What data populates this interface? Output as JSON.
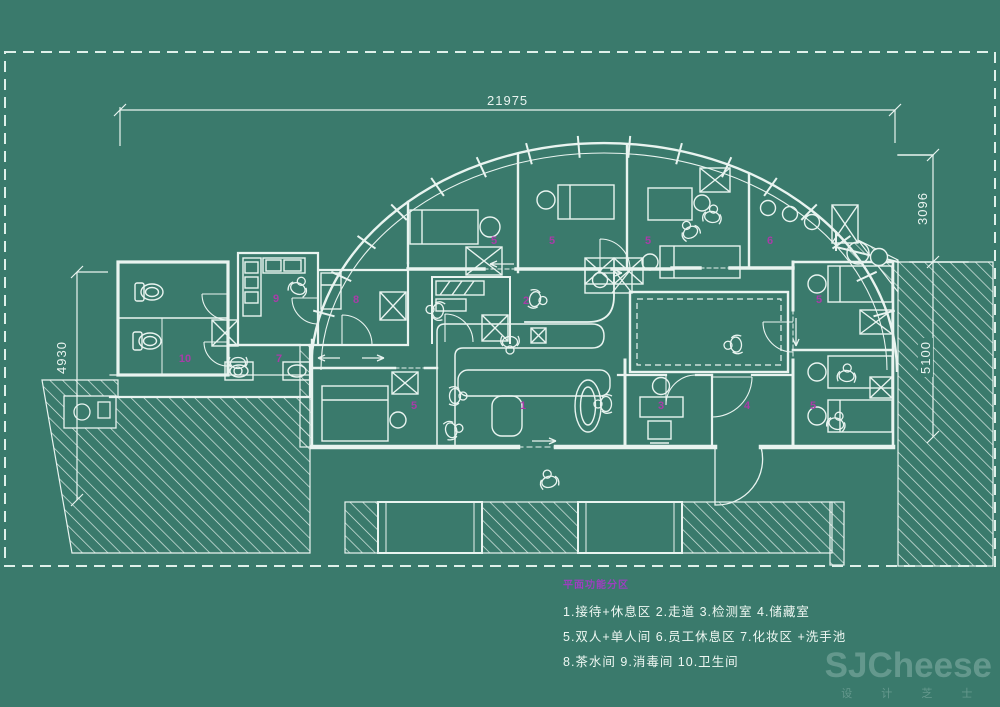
{
  "canvas": {
    "background_color": "#3a7a6c",
    "line_color": "#e9f4f0",
    "accent_magenta": "#a83ca8",
    "legend_title_color": "#9c3fbf"
  },
  "dimensions": {
    "top_width": "21975",
    "right_upper": "3096",
    "right_lower": "5100",
    "left_height": "4930"
  },
  "legend": {
    "title": "平面功能分区",
    "lines": [
      "1.接待+休息区   2.走道   3.检测室  4.储藏室",
      "5.双人+单人间  6.员工休息区  7.化妆区 +洗手池",
      "8.茶水间  9.消毒间   10.卫生间"
    ]
  },
  "rooms": [
    {
      "num": "1",
      "name": "接待+休息区",
      "x": 523,
      "y": 406
    },
    {
      "num": "2",
      "name": "走道",
      "x": 526,
      "y": 301
    },
    {
      "num": "3",
      "name": "检测室",
      "x": 661,
      "y": 406
    },
    {
      "num": "4",
      "name": "储藏室",
      "x": 747,
      "y": 406
    },
    {
      "num": "5",
      "name": "双人+单人间",
      "x": 494,
      "y": 241
    },
    {
      "num": "5",
      "name": "双人+单人间",
      "x": 552,
      "y": 241
    },
    {
      "num": "5",
      "name": "双人+单人间",
      "x": 648,
      "y": 241
    },
    {
      "num": "5",
      "name": "双人+单人间",
      "x": 414,
      "y": 406
    },
    {
      "num": "5",
      "name": "双人+单人间",
      "x": 819,
      "y": 300
    },
    {
      "num": "5",
      "name": "双人+单人间",
      "x": 813,
      "y": 406
    },
    {
      "num": "6",
      "name": "员工休息区",
      "x": 770,
      "y": 241
    },
    {
      "num": "7",
      "name": "化妆区+洗手池",
      "x": 279,
      "y": 359
    },
    {
      "num": "8",
      "name": "茶水间",
      "x": 356,
      "y": 300
    },
    {
      "num": "9",
      "name": "消毒间",
      "x": 276,
      "y": 299
    },
    {
      "num": "10",
      "name": "卫生间",
      "x": 185,
      "y": 359
    }
  ],
  "watermark": {
    "title": "SJCheese",
    "subtitle": "设 计 芝 士"
  }
}
